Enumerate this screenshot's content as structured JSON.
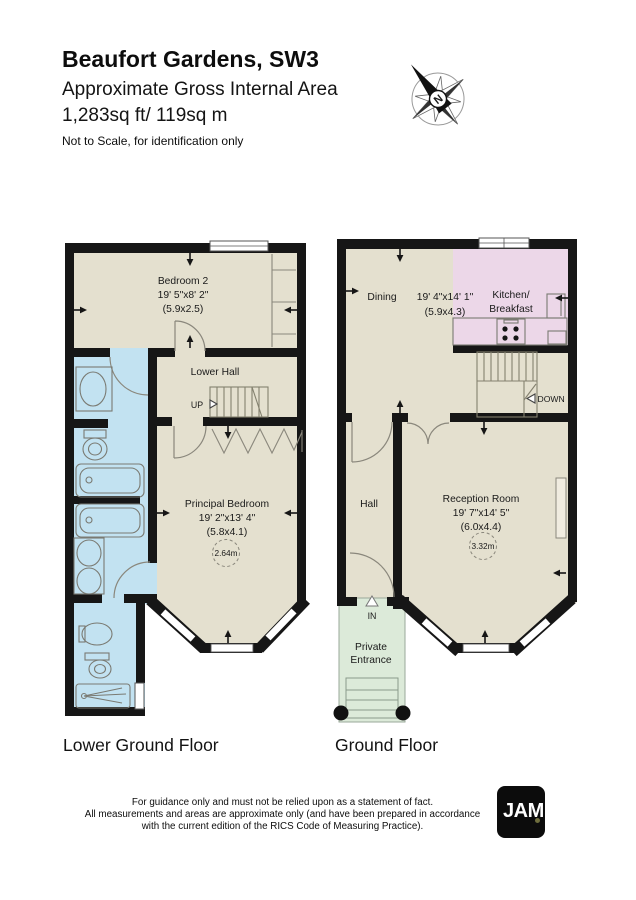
{
  "header": {
    "title": "Beaufort Gardens, SW3",
    "subtitle": "Approximate Gross Internal Area",
    "area": "1,283sq ft/ 119sq m",
    "note": "Not to Scale, for identification only"
  },
  "compass": {
    "north_label": "N"
  },
  "lower_ground_floor": {
    "floor_label": "Lower Ground Floor",
    "bedroom2": {
      "name": "Bedroom 2",
      "dims_imperial": "19' 5\"x8' 2\"",
      "dims_metric": "(5.9x2.5)"
    },
    "lower_hall": {
      "name": "Lower Hall",
      "up_label": "UP"
    },
    "principal_bedroom": {
      "name": "Principal Bedroom",
      "dims_imperial": "19' 2\"x13' 4\"",
      "dims_metric": "(5.8x4.1)",
      "ceiling_height": "2.64m"
    }
  },
  "ground_floor": {
    "floor_label": "Ground Floor",
    "dining": {
      "name": "Dining",
      "dims_imperial": "19' 4\"x14' 1\"",
      "dims_metric": "(5.9x4.3)"
    },
    "kitchen": {
      "name_line1": "Kitchen/",
      "name_line2": "Breakfast"
    },
    "stairs": {
      "down_label": "DOWN"
    },
    "hall": {
      "name": "Hall"
    },
    "reception": {
      "name": "Reception Room",
      "dims_imperial": "19' 7\"x14' 5\"",
      "dims_metric": "(6.0x4.4)",
      "ceiling_height": "3.32m"
    },
    "entrance": {
      "in_label": "IN",
      "name_line1": "Private",
      "name_line2": "Entrance"
    }
  },
  "footer": {
    "disclaimer_line1": "For guidance only and must not be relied upon as a statement of fact.",
    "disclaimer_line2": "All measurements and areas are approximate only (and have been prepared in accordance",
    "disclaimer_line3": "with the current edition of the RICS Code of Measuring Practice).",
    "logo_text": "JAM"
  },
  "colors": {
    "floor_beige": "#e4e0cf",
    "bathroom_blue": "#c2e2f1",
    "kitchen_pink": "#ecd7e8",
    "entrance_green": "#dcead9",
    "wall_black": "#161616"
  }
}
